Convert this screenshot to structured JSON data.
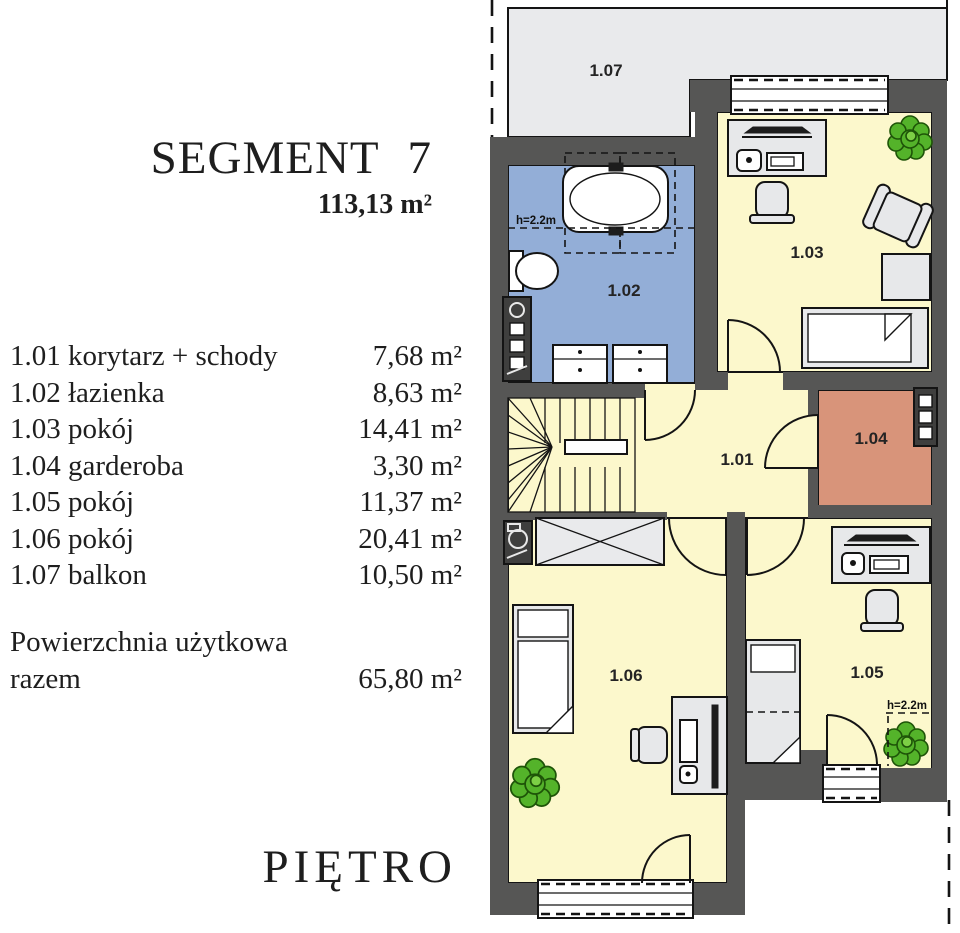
{
  "panel": {
    "title": "SEGMENT 7",
    "total_area": "113,13 m²",
    "rooms": [
      {
        "label": "1.01 korytarz + schody",
        "area": "7,68 m²"
      },
      {
        "label": "1.02 łazienka",
        "area": "8,63 m²"
      },
      {
        "label": "1.03 pokój",
        "area": "14,41 m²"
      },
      {
        "label": "1.04 garderoba",
        "area": "3,30 m²"
      },
      {
        "label": "1.05 pokój",
        "area": "11,37 m²"
      },
      {
        "label": "1.06 pokój",
        "area": "20,41 m²"
      },
      {
        "label": "1.07 balkon",
        "area": "10,50 m²"
      }
    ],
    "usable_area_label_line1": "Powierzchnia użytkowa",
    "usable_area_label_line2": "razem",
    "usable_area_value": "65,80 m²",
    "floor_label": "PIĘTRO"
  },
  "plan": {
    "room_labels": {
      "r101": "1.01",
      "r102": "1.02",
      "r103": "1.03",
      "r104": "1.04",
      "r105": "1.05",
      "r106": "1.06",
      "r107": "1.07"
    },
    "height_label": "h=2.2m"
  },
  "colors": {
    "wall": "#565655",
    "room_yellow": "#fcf8cc",
    "bathroom_blue": "#93aed7",
    "wardrobe_salmon": "#d8947a",
    "balcony_gray": "#e9eaec",
    "furniture": "#e7e8ea",
    "plant_green": "#54b32a",
    "plant_dark": "#1e5408"
  }
}
